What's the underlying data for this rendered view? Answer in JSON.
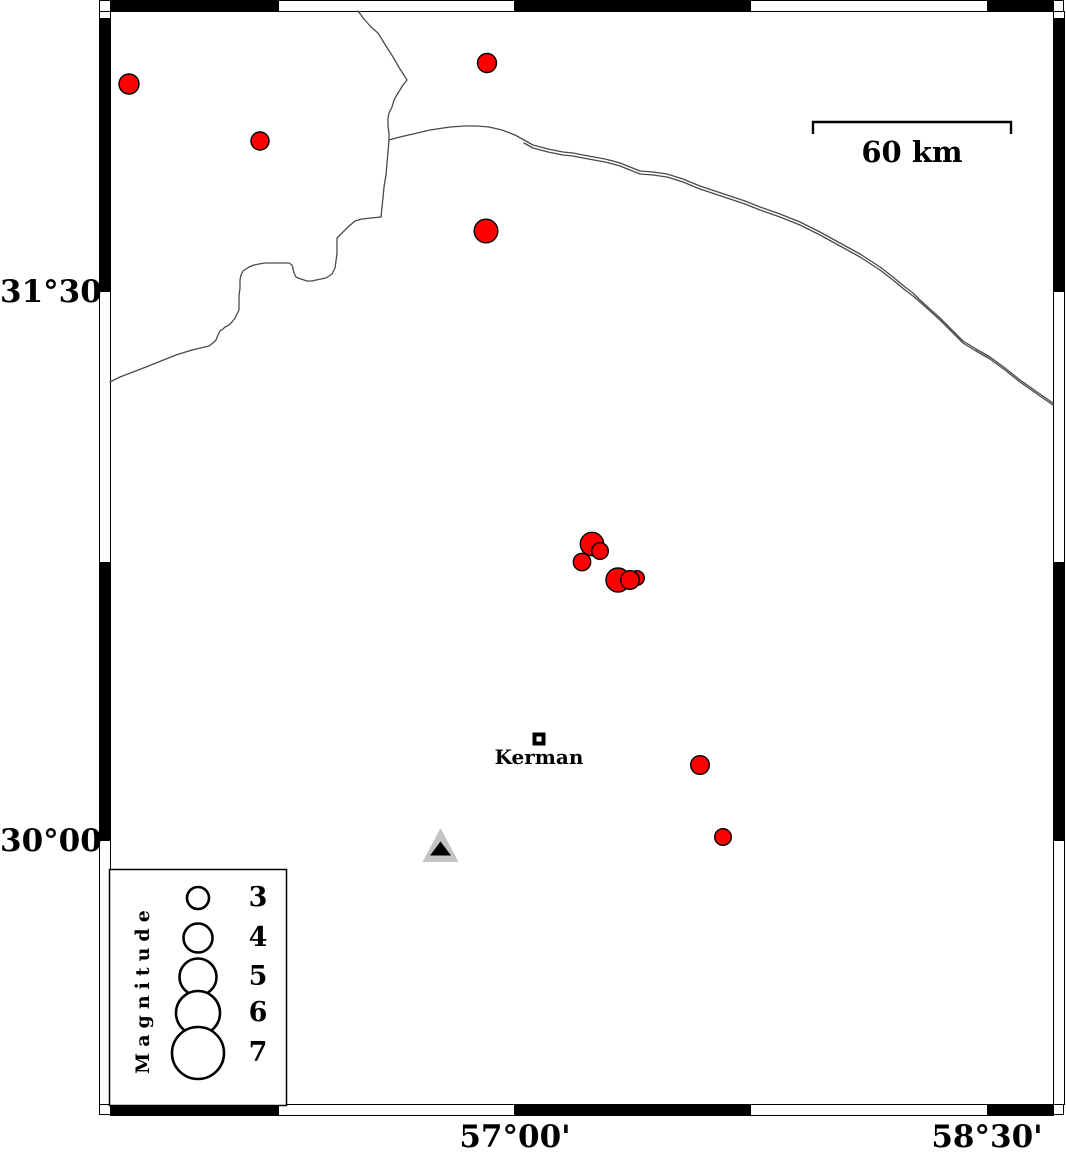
{
  "axis_labels": {
    "left": [
      {
        "text": "31°30'",
        "y": 292
      },
      {
        "text": "30°00'",
        "y": 841
      }
    ],
    "bottom": [
      {
        "text": "57°00'",
        "x": 515
      },
      {
        "text": "58°30'",
        "x": 987
      }
    ]
  },
  "frame": {
    "outer": {
      "x": 99,
      "y": 0,
      "w": 965,
      "h": 1115
    },
    "band": 11,
    "inner": {
      "x0": 110,
      "y0": 11,
      "x1": 1053,
      "y1": 1104
    },
    "top_black_segments": [
      [
        110,
        279
      ],
      [
        514,
        751
      ],
      [
        987,
        1053
      ]
    ],
    "bottom_black_segments": [
      [
        110,
        279
      ],
      [
        514,
        751
      ],
      [
        987,
        1053
      ]
    ],
    "left_black_segments": [
      [
        18,
        292
      ],
      [
        562,
        841
      ]
    ],
    "right_black_segments": [
      [
        18,
        292
      ],
      [
        562,
        841
      ]
    ]
  },
  "scale_bar": {
    "label": "60 km",
    "x1": 813,
    "x2": 1011,
    "y": 122,
    "tick_drop": 12
  },
  "city": {
    "name": "Kerman",
    "marker_x": 539,
    "marker_y": 739
  },
  "station": {
    "x": 440.5,
    "y": 845
  },
  "earthquakes": [
    {
      "x": 129,
      "y": 84,
      "r": 10.0
    },
    {
      "x": 260,
      "y": 141,
      "r": 9.0
    },
    {
      "x": 487,
      "y": 63,
      "r": 9.5
    },
    {
      "x": 486,
      "y": 231,
      "r": 11.8
    },
    {
      "x": 592,
      "y": 544,
      "r": 11.7
    },
    {
      "x": 582,
      "y": 562,
      "r": 8.7
    },
    {
      "x": 600,
      "y": 551,
      "r": 8.3
    },
    {
      "x": 618,
      "y": 580,
      "r": 12.0
    },
    {
      "x": 637,
      "y": 578,
      "r": 7.3
    },
    {
      "x": 630,
      "y": 580,
      "r": 9.3
    },
    {
      "x": 700,
      "y": 765,
      "r": 9.3
    },
    {
      "x": 723,
      "y": 837,
      "r": 8.3
    }
  ],
  "legend": {
    "title": "Magnitude",
    "box": {
      "x": 109,
      "y": 869,
      "w": 177,
      "h": 236
    },
    "circle_cx": 198,
    "label_x": 258,
    "entries": [
      {
        "label": "3",
        "r": 11,
        "cy": 898
      },
      {
        "label": "4",
        "r": 14.5,
        "cy": 938
      },
      {
        "label": "5",
        "r": 18.5,
        "cy": 977
      },
      {
        "label": "6",
        "r": 22,
        "cy": 1013
      },
      {
        "label": "7",
        "r": 26,
        "cy": 1053
      }
    ]
  },
  "colors": {
    "epicenter_fill": "#ff0000",
    "outline": "#000000",
    "boundary_line": "#4a4a4a",
    "station_fill": "#c3c3c3",
    "station_inner": "#000000"
  }
}
